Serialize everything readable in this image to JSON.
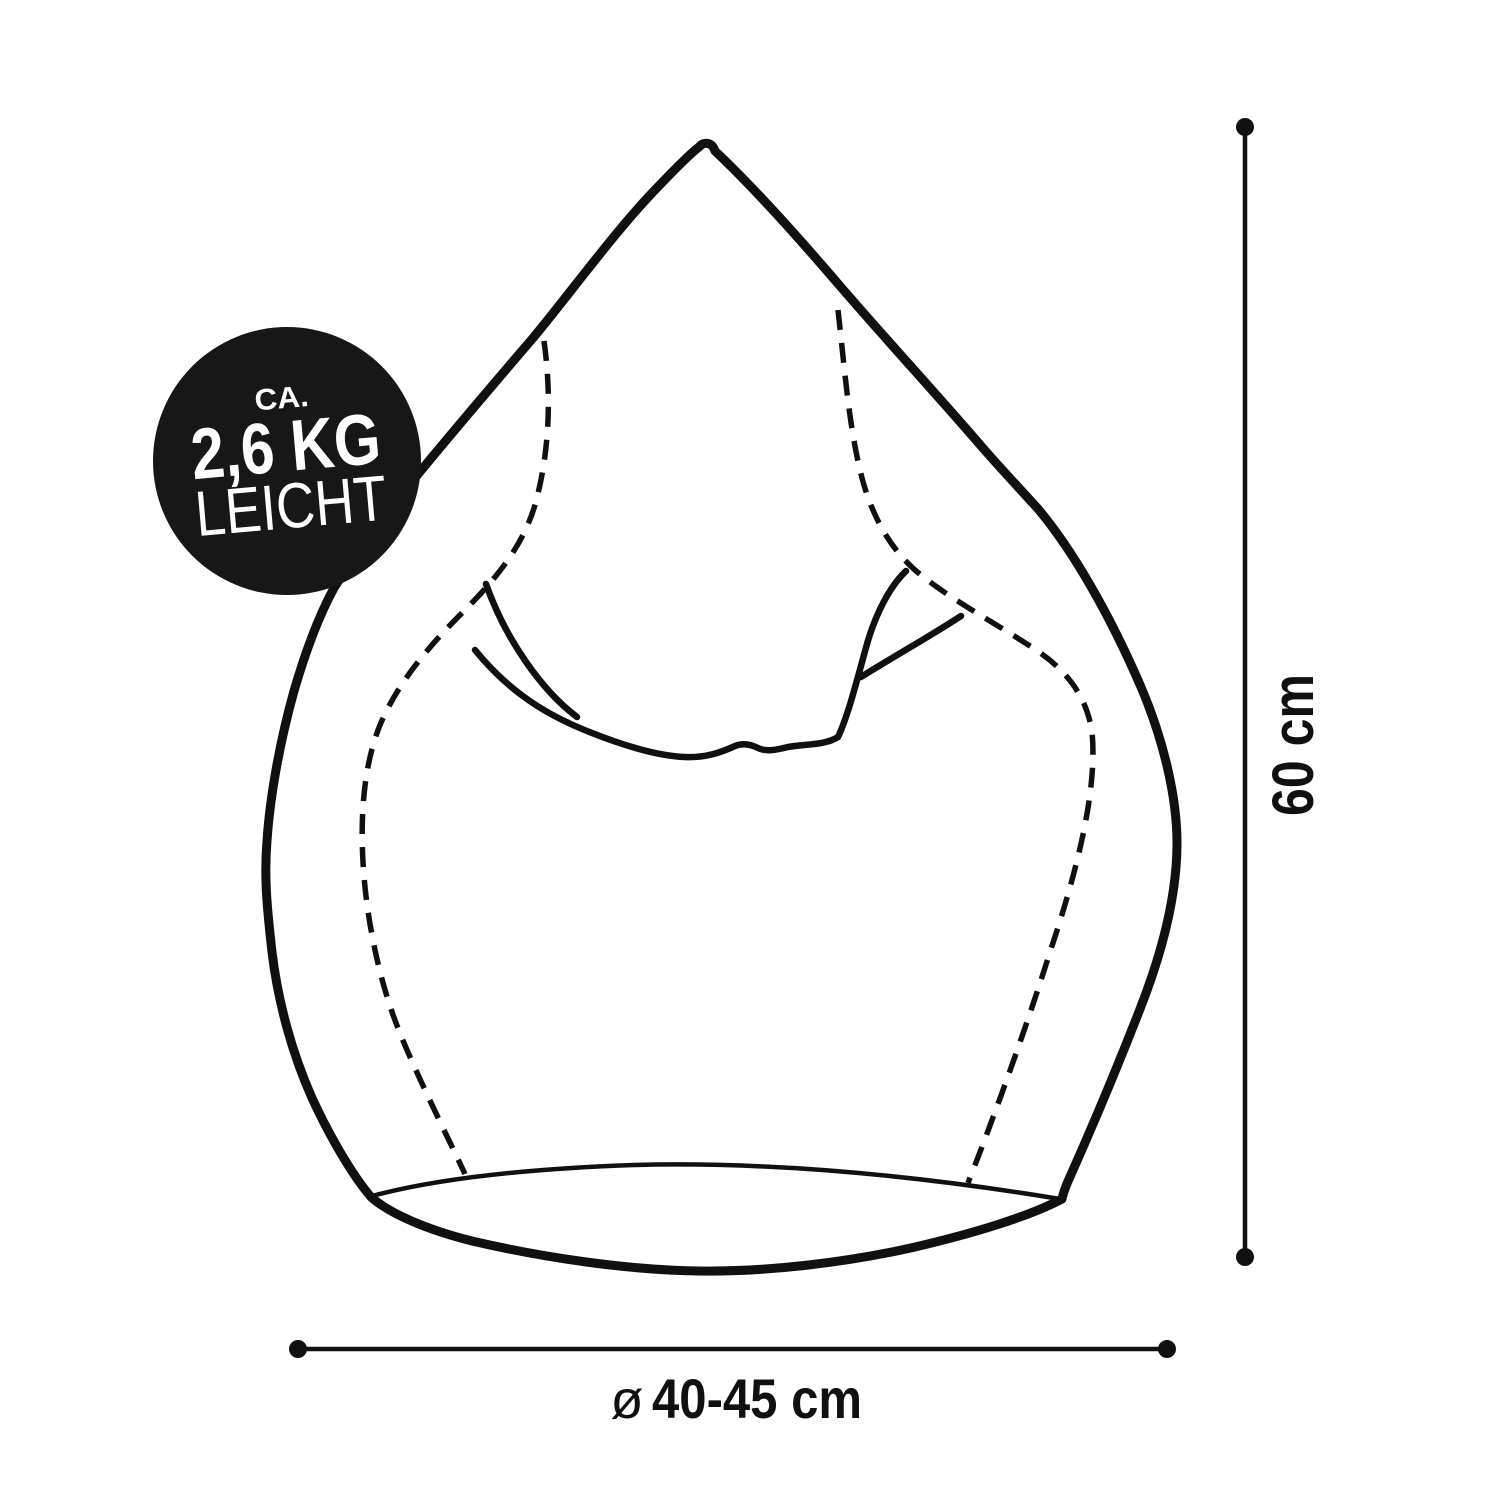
{
  "badge": {
    "prefix": "CA.",
    "weight": "2,6 KG",
    "suffix": "LEICHT"
  },
  "dimensions": {
    "height": {
      "label": "60 cm"
    },
    "diameter": {
      "symbol": "ø",
      "label": "40-45 cm"
    }
  },
  "colors": {
    "ink": "#101010",
    "badge_bg": "#171717",
    "badge_text": "#ffffff",
    "background": "#ffffff"
  }
}
